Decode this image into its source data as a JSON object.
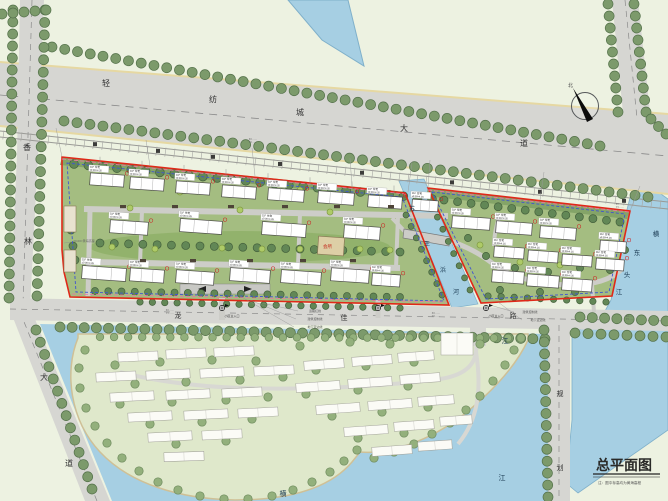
{
  "map_title": {
    "text": "总平面图",
    "note": "注：图中标高均为黄海高程"
  },
  "north": {
    "label": "北"
  },
  "roads": {
    "main_avenue": {
      "name": "轻纺城大道",
      "chars": [
        "轻",
        "纺",
        "城",
        "大",
        "道"
      ]
    },
    "west_avenue": {
      "name": "香林大道",
      "chars": [
        "香",
        "林",
        "大",
        "道"
      ]
    },
    "south_road": {
      "name": "龙佳路",
      "chars": [
        "龙",
        "佳",
        "路"
      ]
    },
    "planned_road": {
      "name": "规划道路",
      "chars": [
        "规",
        "划"
      ]
    }
  },
  "waterways": {
    "canal": {
      "name": "苏王浜河",
      "chars": [
        "苏",
        "王",
        "浜",
        "河"
      ]
    },
    "east_river": {
      "name": "横东头江",
      "chars": [
        "横",
        "东",
        "头",
        "江"
      ]
    },
    "south_lake_chars": [
      "横",
      "江",
      "江"
    ]
  },
  "annotations": {
    "road_red_line": "道路红线",
    "building_control_line": "建筑控制线",
    "basement_line": "地下室边线",
    "main_entrance": "小区主入口",
    "elevation_note": "±0.00=黄海高程",
    "coord_x": "X=······",
    "coord_y": "Y=······"
  },
  "buildings": {
    "residential_tag": "11F 住宅",
    "elevation_tag": "±0.00=4.35",
    "clubhouse": "会所"
  },
  "colors": {
    "site_boundary_red": "#e02818",
    "control_line_blue": "#4054d0",
    "red_line_pink": "#e878a0",
    "water": "#a6cfe3",
    "road": "#d6d6d2",
    "parcel_green": "#a4bd81"
  }
}
